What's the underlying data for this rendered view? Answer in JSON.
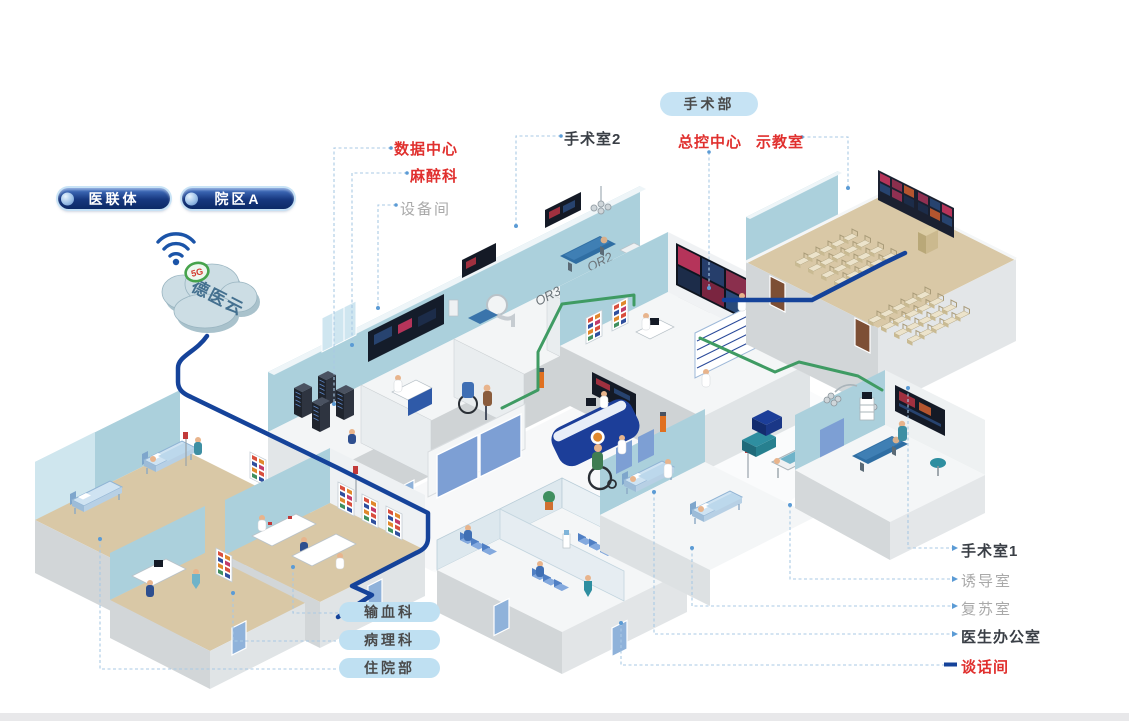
{
  "org_pills": {
    "alliance": "医联体",
    "campus_a": "院区A"
  },
  "cloud": {
    "name": "德医云",
    "badge": "5G"
  },
  "surgery_pill": "手术部",
  "dept_pills": {
    "blood": "输血科",
    "pathology": "病理科",
    "inpatient": "住院部"
  },
  "callouts": {
    "data_center": "数据中心",
    "anesthesia": "麻醉科",
    "equipment_room": "设备间",
    "or_room2": "手术室2",
    "master_control": "总控中心",
    "demo_room": "示教室",
    "or_room1": "手术室1",
    "induction_room": "诱导室",
    "recovery_room": "复苏室",
    "doctor_office": "医生办公室",
    "talk_room": "谈话间"
  },
  "wall_marks": {
    "or2": "OR2",
    "or3": "OR3"
  },
  "colors": {
    "red_label": "#e0302e",
    "dark_label": "#3a3f46",
    "gray_label": "#a9a9a9",
    "pill_light_blue": "#bfe0f2",
    "nav_pill_navy": "#16377e",
    "cable_navy": "#15439a",
    "cable_green": "#3f9b63",
    "wall_blue": "#abd0dc",
    "floor_tan": "#d9c8a6",
    "leader_blue": "#a9c9e4"
  }
}
